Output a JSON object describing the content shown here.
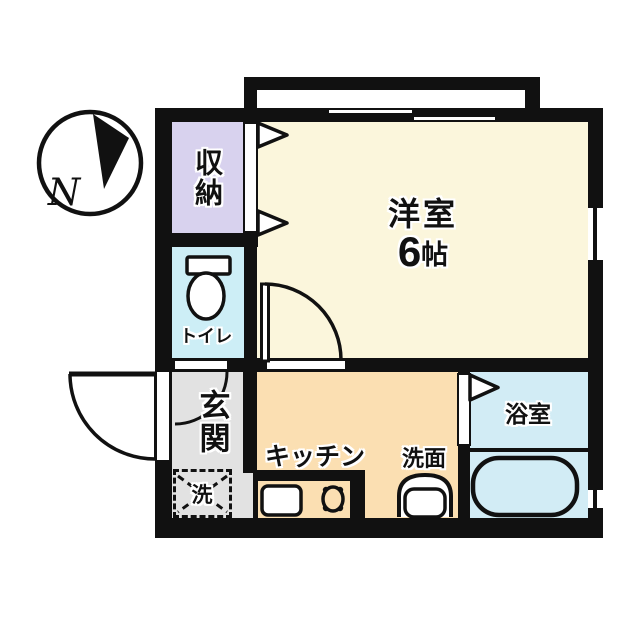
{
  "title": "apartment-floor-plan",
  "compass": {
    "label": "N"
  },
  "wall_color": "#111111",
  "rooms": {
    "storage": {
      "label": "収納",
      "color": "#d8d2ee"
    },
    "western_room": {
      "label": "洋室",
      "size_value": "6",
      "size_unit": "帖",
      "color": "#fbf6dc"
    },
    "toilet": {
      "label": "トイレ",
      "color": "#cdeef6"
    },
    "entrance": {
      "label": "玄関",
      "color": "#e2e2e2"
    },
    "laundry": {
      "label": "洗",
      "color": "#e2e2e2"
    },
    "kitchen": {
      "label": "キッチン",
      "color": "#fbdfb2"
    },
    "washstand": {
      "label": "洗面",
      "color": "#fbdfb2"
    },
    "bathroom": {
      "label": "浴室",
      "color": "#d2ecf5"
    }
  }
}
